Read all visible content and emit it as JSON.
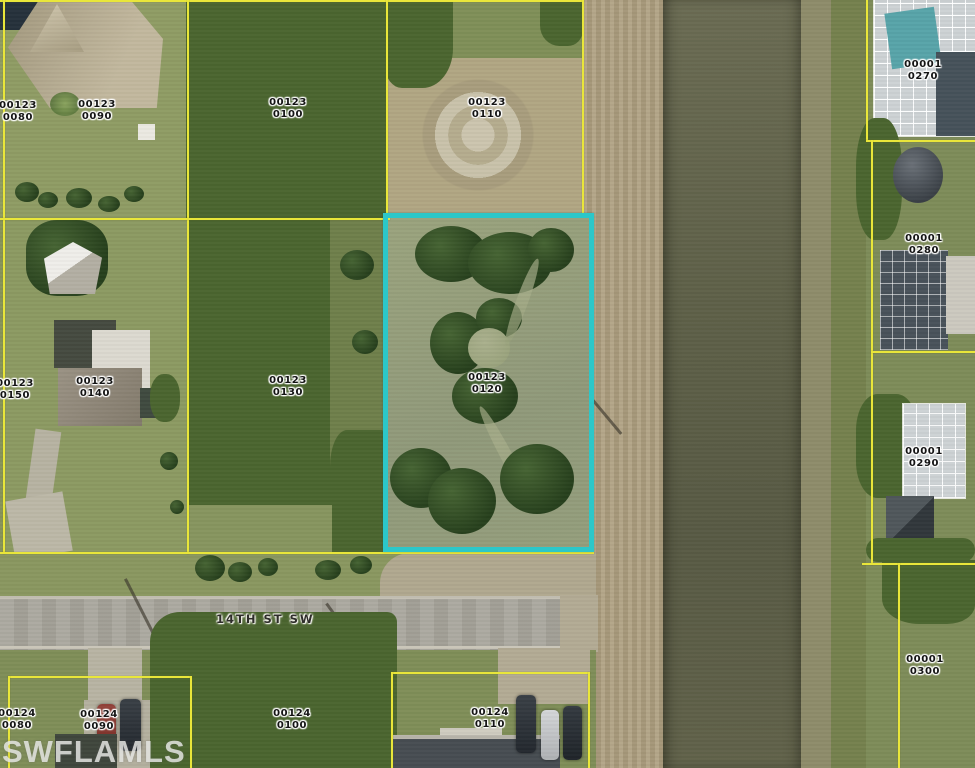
{
  "map": {
    "watermark": "SWFLAMLS",
    "street_label": "14TH ST SW",
    "highlight_color": "#2cc7c9",
    "parcel_line_color": "#e9e63a",
    "highlighted_parcel": "00123 0120",
    "labels": [
      {
        "line1": "00123",
        "line2": "0080"
      },
      {
        "line1": "00123",
        "line2": "0090"
      },
      {
        "line1": "00123",
        "line2": "0100"
      },
      {
        "line1": "00123",
        "line2": "0110"
      },
      {
        "line1": "00123",
        "line2": "0150"
      },
      {
        "line1": "00123",
        "line2": "0140"
      },
      {
        "line1": "00123",
        "line2": "0130"
      },
      {
        "line1": "00123",
        "line2": "0120"
      },
      {
        "line1": "00001",
        "line2": "0270"
      },
      {
        "line1": "00001",
        "line2": "0280"
      },
      {
        "line1": "00001",
        "line2": "0290"
      },
      {
        "line1": "00001",
        "line2": "0300"
      },
      {
        "line1": "00124",
        "line2": "0080"
      },
      {
        "line1": "00124",
        "line2": "0090"
      },
      {
        "line1": "00124",
        "line2": "0100"
      },
      {
        "line1": "00124",
        "line2": "0110"
      }
    ]
  }
}
